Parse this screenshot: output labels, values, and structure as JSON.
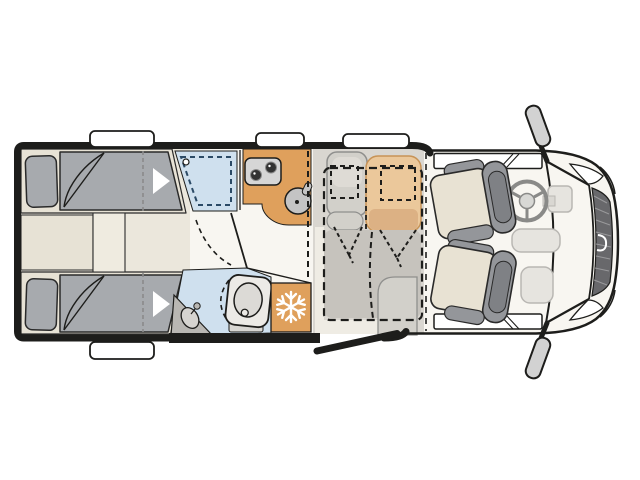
{
  "title": "Motorhome floor plan, top view",
  "icons": {
    "freezer_badge": "snowflake-icon",
    "bed_direction": "arrow-right-icon"
  },
  "colors": {
    "wall": "#1d1d1b",
    "floor_bedroom": "#ebe7dc",
    "floor_corridor": "#f8f6f1",
    "floor_dinette": "#d9d6d0",
    "floor_dinette_light": "#efece4",
    "bed_base": "#e7e2d5",
    "mattress": "#a7aaae",
    "water_blue": "#cfe0ee",
    "water_dash": "#2b4a66",
    "kitchen_orange": "#dfa05c",
    "seat_orange": "#ebc89b",
    "seat_orange_dark": "#dcb184",
    "bench_gray": "#d2d0ca",
    "bench_inner": "#dedbd5",
    "dropbed_gray": "#c6c3bd",
    "cab_body": "#f8f6f1",
    "seat_beige": "#e8e2d3",
    "seat_gray": "#94969a",
    "seat_gray_dark": "#7f8185",
    "appliance_gray": "#d6d6d6",
    "burner_dark": "#333333",
    "sink_gray": "#c4c4c4",
    "vanity_gray": "#b9b7b3",
    "toilet_white": "#eceae6",
    "toilet_inner": "#dcdad6",
    "grille_dark": "#68686b",
    "dash_panel": "#e6e4df",
    "mirror_gray": "#d2d2d2",
    "window_white": "#ffffff"
  },
  "areas": [
    {
      "id": "rear-bedroom",
      "items": [
        "single-bed-top",
        "single-bed-bottom",
        "center-cabinets"
      ]
    },
    {
      "id": "washroom",
      "items": [
        "shower",
        "toilet",
        "vanity-sink"
      ]
    },
    {
      "id": "kitchen",
      "items": [
        "two-burner-stove",
        "round-sink",
        "overhead-cabinet-dashed",
        "fridge-freezer"
      ]
    },
    {
      "id": "dinette",
      "items": [
        "bench-seat",
        "side-seat",
        "drop-down-bed-dashed",
        "belted-seat-marks",
        "entry-door-open"
      ]
    },
    {
      "id": "cab",
      "items": [
        "driver-swivel-seat",
        "passenger-swivel-seat",
        "steering-wheel",
        "dashboard",
        "windshield",
        "grille",
        "headlights",
        "door-windows",
        "side-mirrors"
      ]
    }
  ]
}
